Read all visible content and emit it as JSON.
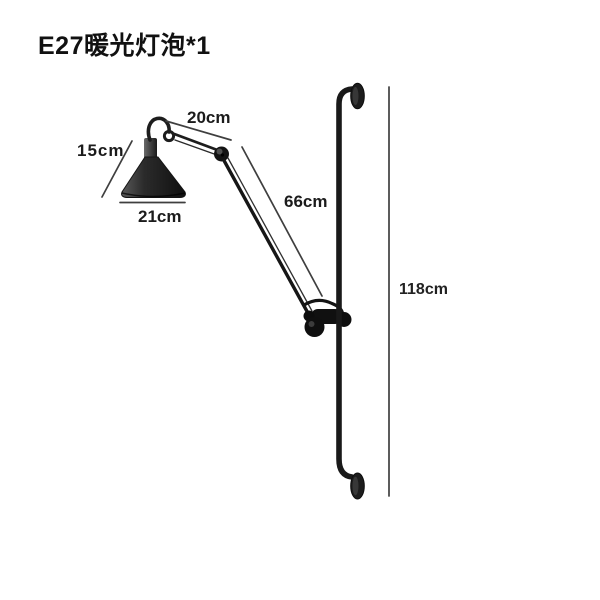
{
  "header": {
    "title": "E27暖光灯泡*1"
  },
  "diagram": {
    "type": "product-dimension-diagram",
    "subject": "wall-mounted adjustable swing-arm lamp on vertical pole",
    "dimensions": [
      {
        "id": "upper-arm-length",
        "label": "20cm",
        "measures": "short upper arm segment"
      },
      {
        "id": "shade-height",
        "label": "15cm",
        "measures": "lamp shade height"
      },
      {
        "id": "shade-diameter",
        "label": "21cm",
        "measures": "lamp shade base diameter"
      },
      {
        "id": "long-arm-length",
        "label": "66cm",
        "measures": "long lower arm segment"
      },
      {
        "id": "pole-height",
        "label": "118cm",
        "measures": "wall pole overall height"
      }
    ],
    "colors": {
      "fixture": "#1c1c1c",
      "dimension_line": "#3f3f3f",
      "label_text": "#1b1b1b",
      "background": "#ffffff"
    }
  }
}
